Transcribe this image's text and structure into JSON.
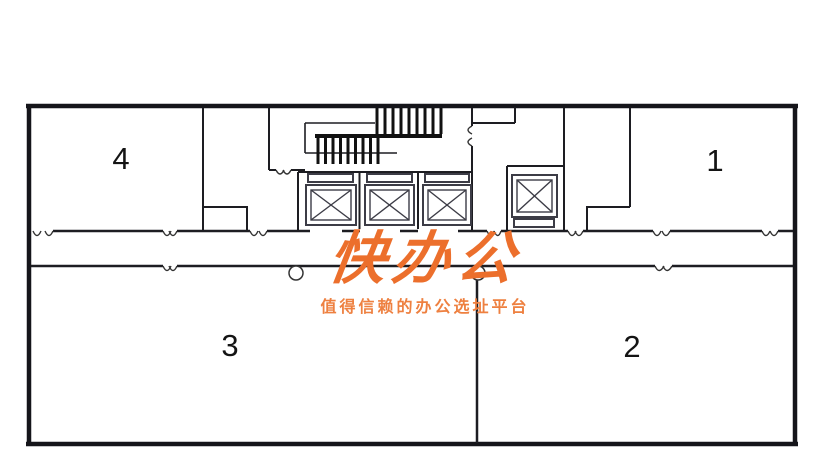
{
  "watermark": {
    "logo_text": "快办公",
    "tagline": "值得信赖的办公选址平台",
    "logo_color": "#EC6F2C",
    "tagline_color": "#EE8040"
  },
  "rooms": {
    "room1": "1",
    "room2": "2",
    "room3": "3",
    "room4": "4"
  },
  "plan": {
    "wall_color": "#1b1b20",
    "elevator_line_color": "#3c3c46"
  }
}
